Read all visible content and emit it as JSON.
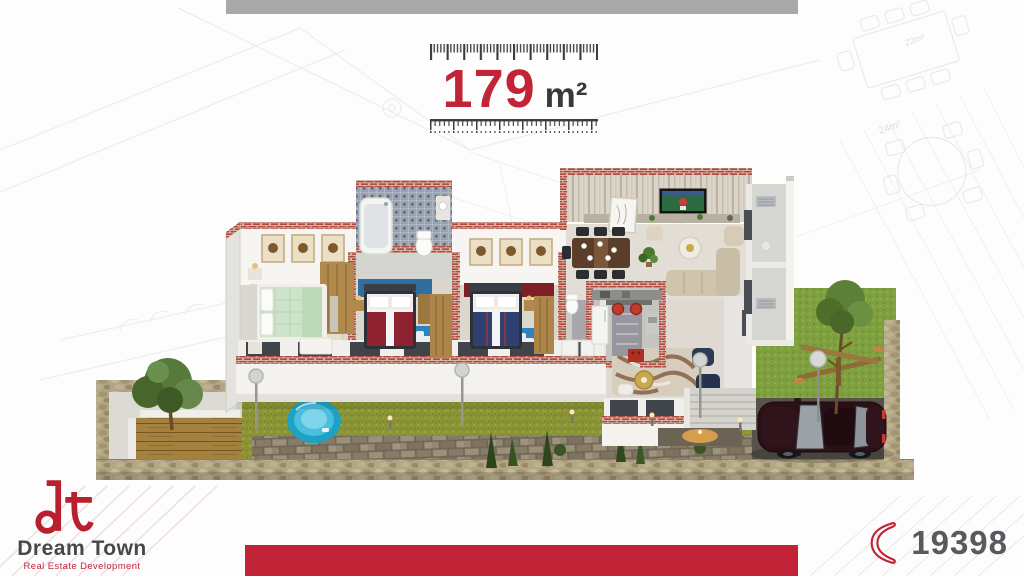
{
  "header": {
    "area_value": "179",
    "area_unit": "m²"
  },
  "logo": {
    "monogram": "dt",
    "name": "Dream Town",
    "tagline": "Real Estate Development"
  },
  "contact": {
    "phone": "19398"
  },
  "blueprint": {
    "room_small": "22m²",
    "room_large": "24m²"
  },
  "colors": {
    "accent_red": "#c32337",
    "top_band_gray": "#a9a9a9",
    "dark_text": "#3a3a3c",
    "phone_text_gray": "#595a5e",
    "brick_cap": "#b04a3e",
    "grass_olive": "#8b9537",
    "grass_bright": "#7fa03e",
    "pool_blue": "#1ea2c4",
    "car_maroon": "#2b1016",
    "stone_wall_tan": "#b2a687"
  }
}
